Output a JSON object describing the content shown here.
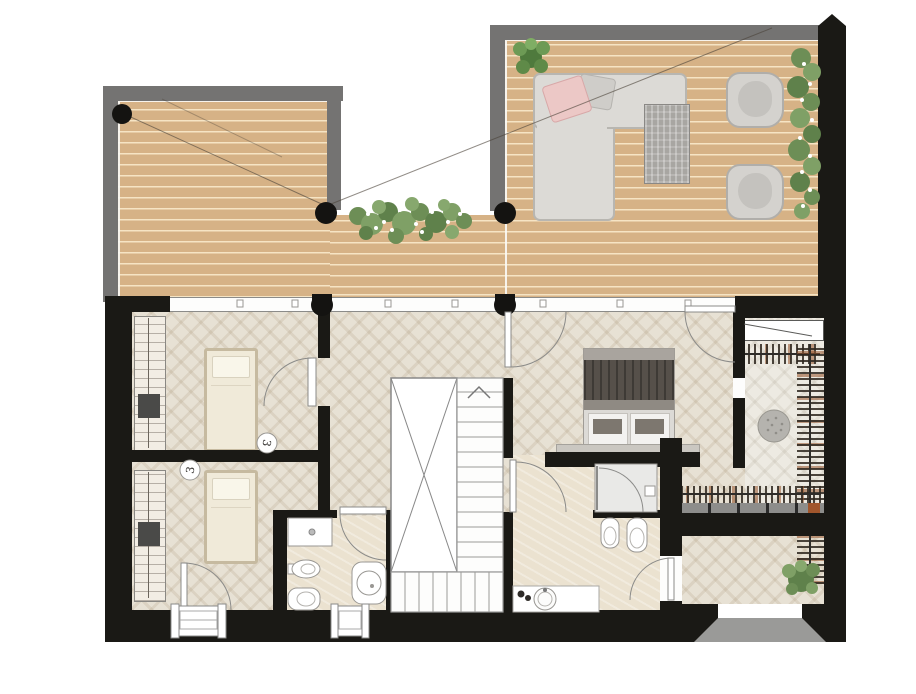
{
  "plan": {
    "kind": "architectural-floor-plan",
    "view": "top-down",
    "visible_text": [],
    "background": "#ffffff"
  },
  "palette": {
    "wall_black": "#1a1915",
    "parapet_gray": "#747372",
    "deck_wood": "#d6b286",
    "deck_plank_line": "#f7e7c7",
    "interior_floor": "#e7e1d4",
    "closet_floor": "#edeae2",
    "bathroom_floor": "#ebe2d0",
    "glass_line": "#8b8b89",
    "fixture_white": "#ffffff",
    "fixture_stroke": "#999793",
    "furniture_gray": "#dcdad6",
    "bed_linen": "#f0ead9",
    "bed_frame_tan": "#c6baa0",
    "master_blanket": "#56504a",
    "accent_pillow_pink": "#ecc8c6",
    "plant_green": "#6d8e56",
    "flower_white": "#ffffff"
  },
  "terrace": {
    "deck_material": "wood-planks",
    "round_columns": 3,
    "half_columns_on_glass_wall": 2,
    "items": [
      "l-shaped-sofa",
      "pink-cushion",
      "gray-cushion",
      "coffee-table",
      "lounge-chair",
      "lounge-chair",
      "flower-planter",
      "hedge-plants",
      "corner-plant"
    ]
  },
  "rooms": [
    {
      "id": "bedroom-1",
      "floor": "herringbone",
      "items": [
        "single-bed",
        "wardrobe",
        "swing-door",
        "sensor-marker"
      ]
    },
    {
      "id": "bedroom-2",
      "floor": "herringbone",
      "items": [
        "single-bed",
        "wardrobe",
        "exterior-door",
        "window",
        "sensor-marker"
      ]
    },
    {
      "id": "hallway",
      "floor": "herringbone",
      "items": [
        "staircase"
      ]
    },
    {
      "id": "master-bedroom",
      "floor": "herringbone",
      "items": [
        "double-bed",
        "bench",
        "terrace-door",
        "terrace-door",
        "closet-opening"
      ]
    },
    {
      "id": "walk-in-closet",
      "floor": "herringbone-light",
      "items": [
        "counter",
        "clothes-rail-top",
        "clothes-rail-side",
        "clothes-rail-bottom",
        "shelf-bins",
        "pouf"
      ]
    },
    {
      "id": "bathroom-1",
      "floor": "stone-beige",
      "items": [
        "vanity",
        "bidet",
        "wc",
        "shower-tray",
        "entry-door",
        "window"
      ]
    },
    {
      "id": "bathroom-2",
      "floor": "stone-beige",
      "items": [
        "shower-enclosure",
        "bidet",
        "wc",
        "vanity-round-sink",
        "hall-door",
        "balcony-door"
      ]
    },
    {
      "id": "balcony",
      "floor": "wood-planks",
      "items": [
        "tree-planter",
        "wall-opening",
        "entry-ramp"
      ]
    }
  ],
  "stairs": {
    "direction": "up",
    "flights": 2,
    "treads_main_flight": 13,
    "treads_lower_flight": 8,
    "void": "x-marked"
  },
  "symbols": {
    "sensor_markers": 2,
    "marker_glyph": "3"
  }
}
